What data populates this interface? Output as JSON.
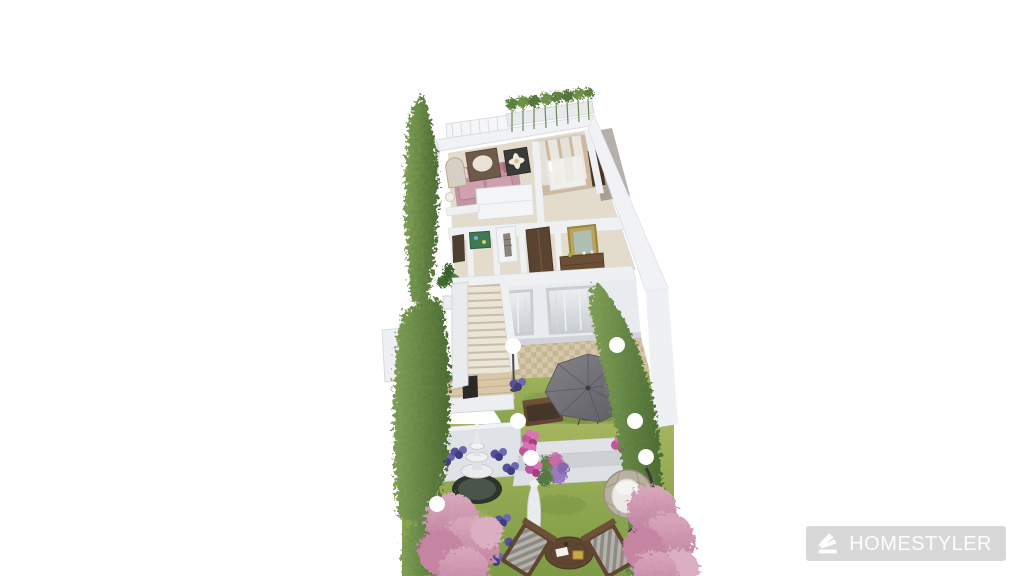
{
  "canvas": {
    "width": 1024,
    "height": 576,
    "background": "#ffffff"
  },
  "watermark": {
    "label": "HOMESTYLER",
    "icon": "homestyler-fan-logo-icon"
  },
  "palette": {
    "background": "#ffffff",
    "wall_light": "#f0f2f5",
    "wall_mid": "#e2e4e8",
    "wall_dark": "#c6c8cf",
    "floor_wood": "#e3dccd",
    "bedroom_floor": "#cdb9a2",
    "tile_light": "#d6c9ab",
    "tile_dark": "#c5b795",
    "grass_light": "#a3b55e",
    "grass_dark": "#7d9a44",
    "hedge_light": "#7fa057",
    "hedge_dark": "#4c6b33",
    "blossom_light": "#d9a8bd",
    "blossom_dark": "#bd7f9d",
    "flower_purple": "#55519b",
    "flower_magenta": "#c2539d",
    "umbrella_gray": "#737179",
    "wood_brown": "#5f4631",
    "sofa_pink": "#c394a2",
    "pool_dark": "#2e332c",
    "fire_orange": "#c96a2b",
    "watermark_bg": "#d8d8d8",
    "watermark_text": "#fdfdfd"
  }
}
